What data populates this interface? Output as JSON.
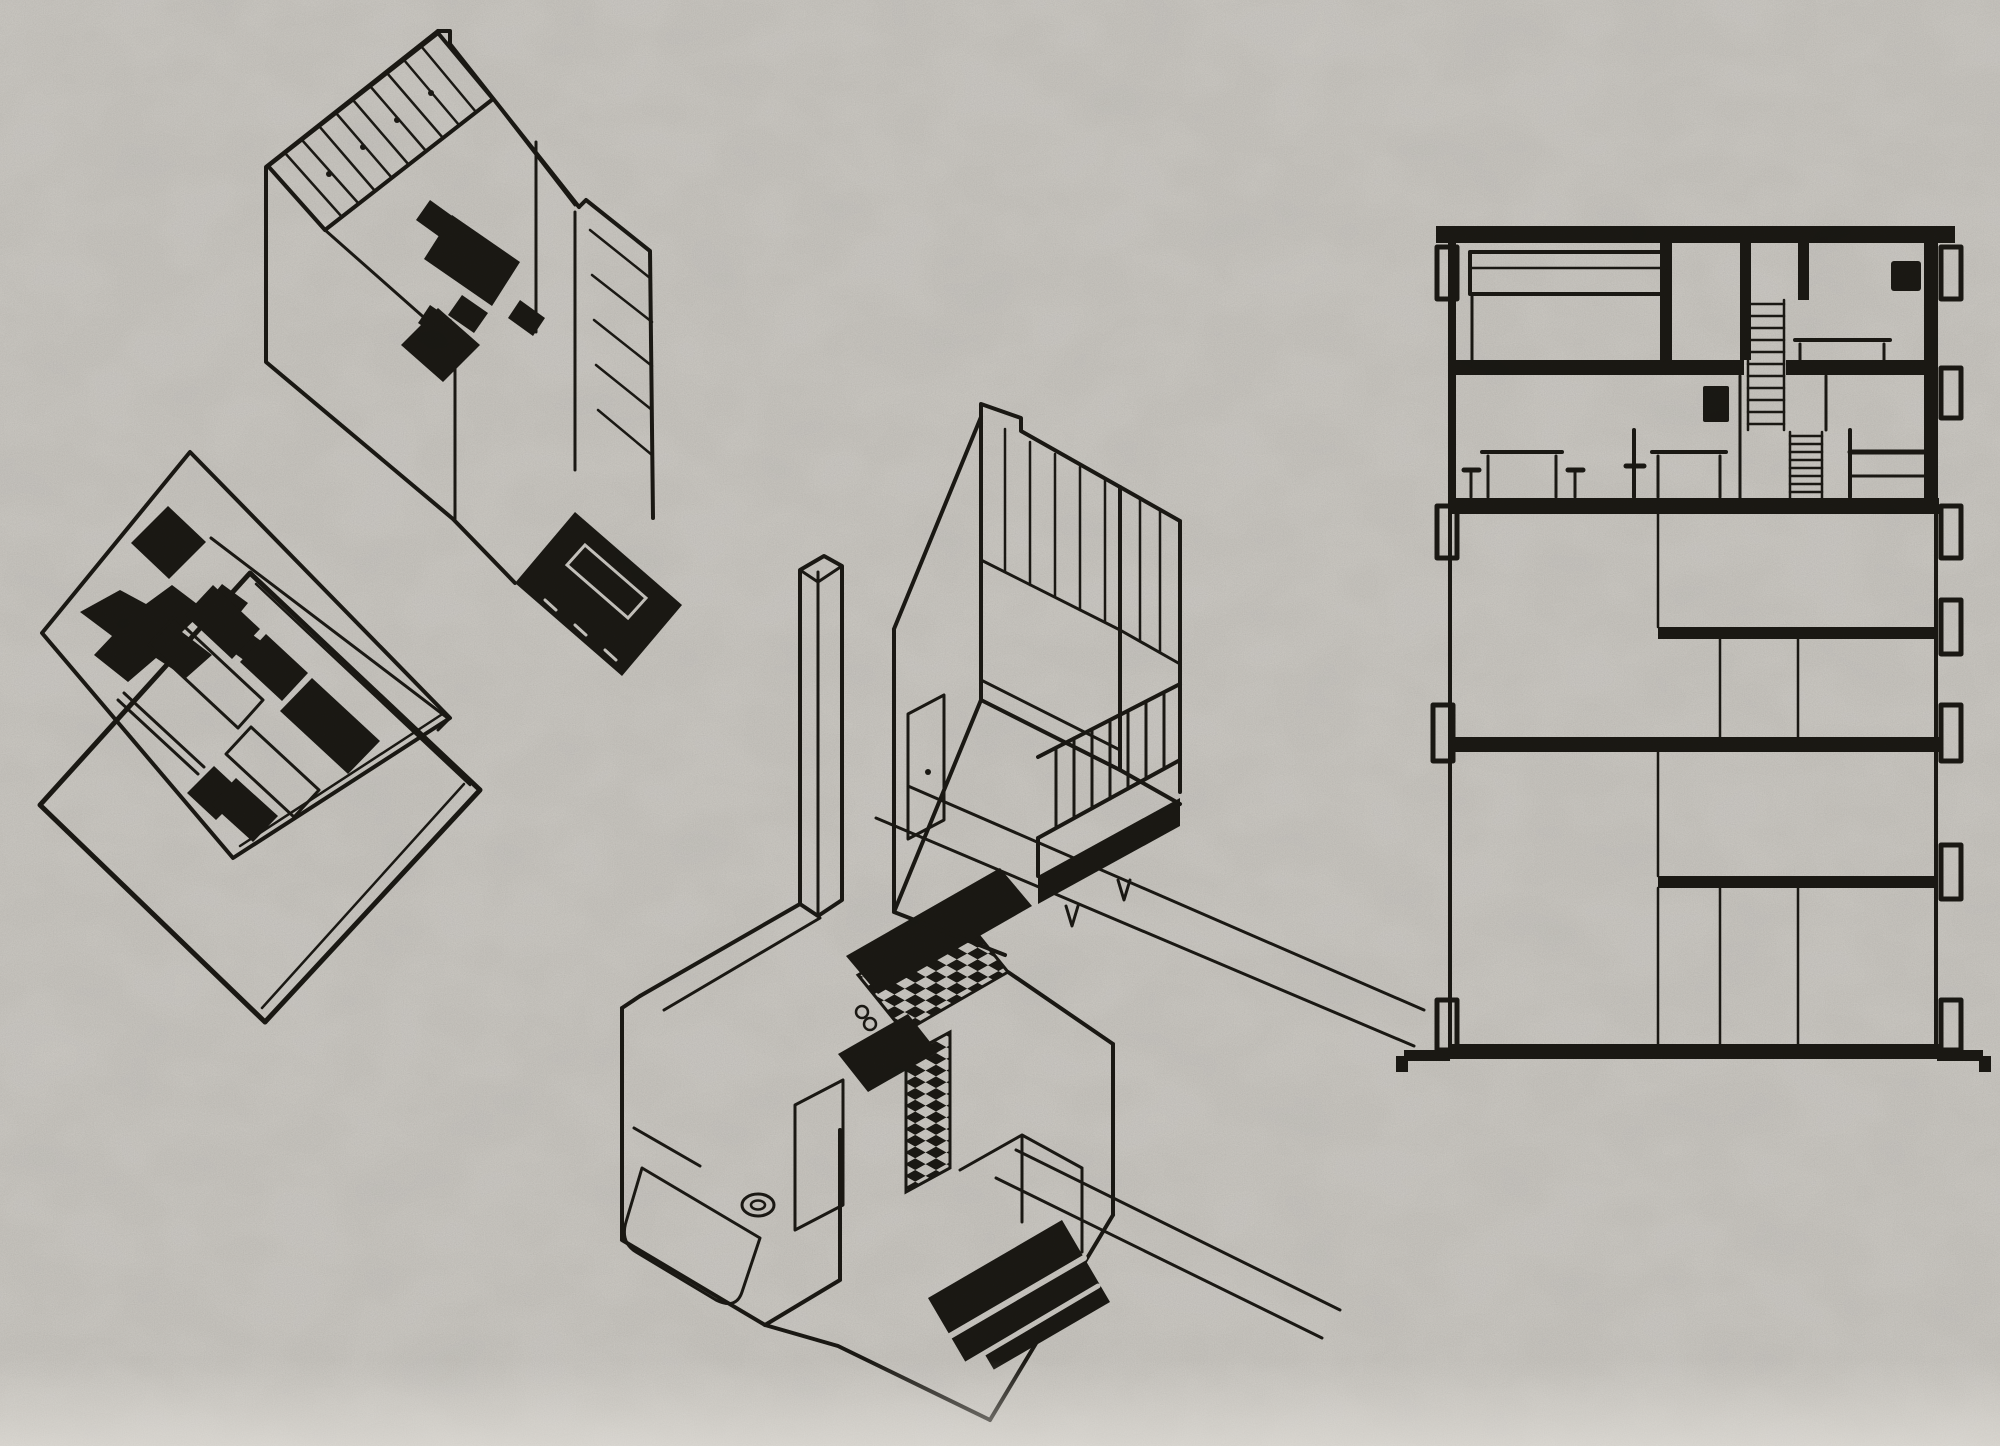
{
  "artifact": {
    "kind": "scanned-architectural-plate",
    "visible_text": []
  },
  "palette": {
    "paper": "#d2cfc9",
    "ink": "#1b1914"
  },
  "figures": [
    {
      "id": "axon-upper-level",
      "description": "Axonometric cutaway of an apartment upper level: board-striped walls, black dining table and chairs, black bed block at the lower right"
    },
    {
      "id": "axon-floor-plate",
      "description": "Axonometric plan plate with black furniture blocks and outlined tables, floating above an empty lower slab drawn as a plain diamond outline"
    },
    {
      "id": "axon-living-room-balcony",
      "description": "Axonometric of a living room corner: glazed mullioned window walls, door opening, cantilevered balcony with railing and black bench"
    },
    {
      "id": "axon-service-core",
      "description": "Axonometric of the service core: tall thin duct slab, bathroom with checkerboard tile floor, bathtub, WC, black kitchen counters and a black striped table; long slab-edge diagonals run to the right"
    },
    {
      "id": "building-section",
      "description": "Cross-section through the slab block: two furnished duplex levels at the top with beds, tables, stools and hatched stair flights, empty structural floors below, balcony brackets on both facades"
    }
  ]
}
